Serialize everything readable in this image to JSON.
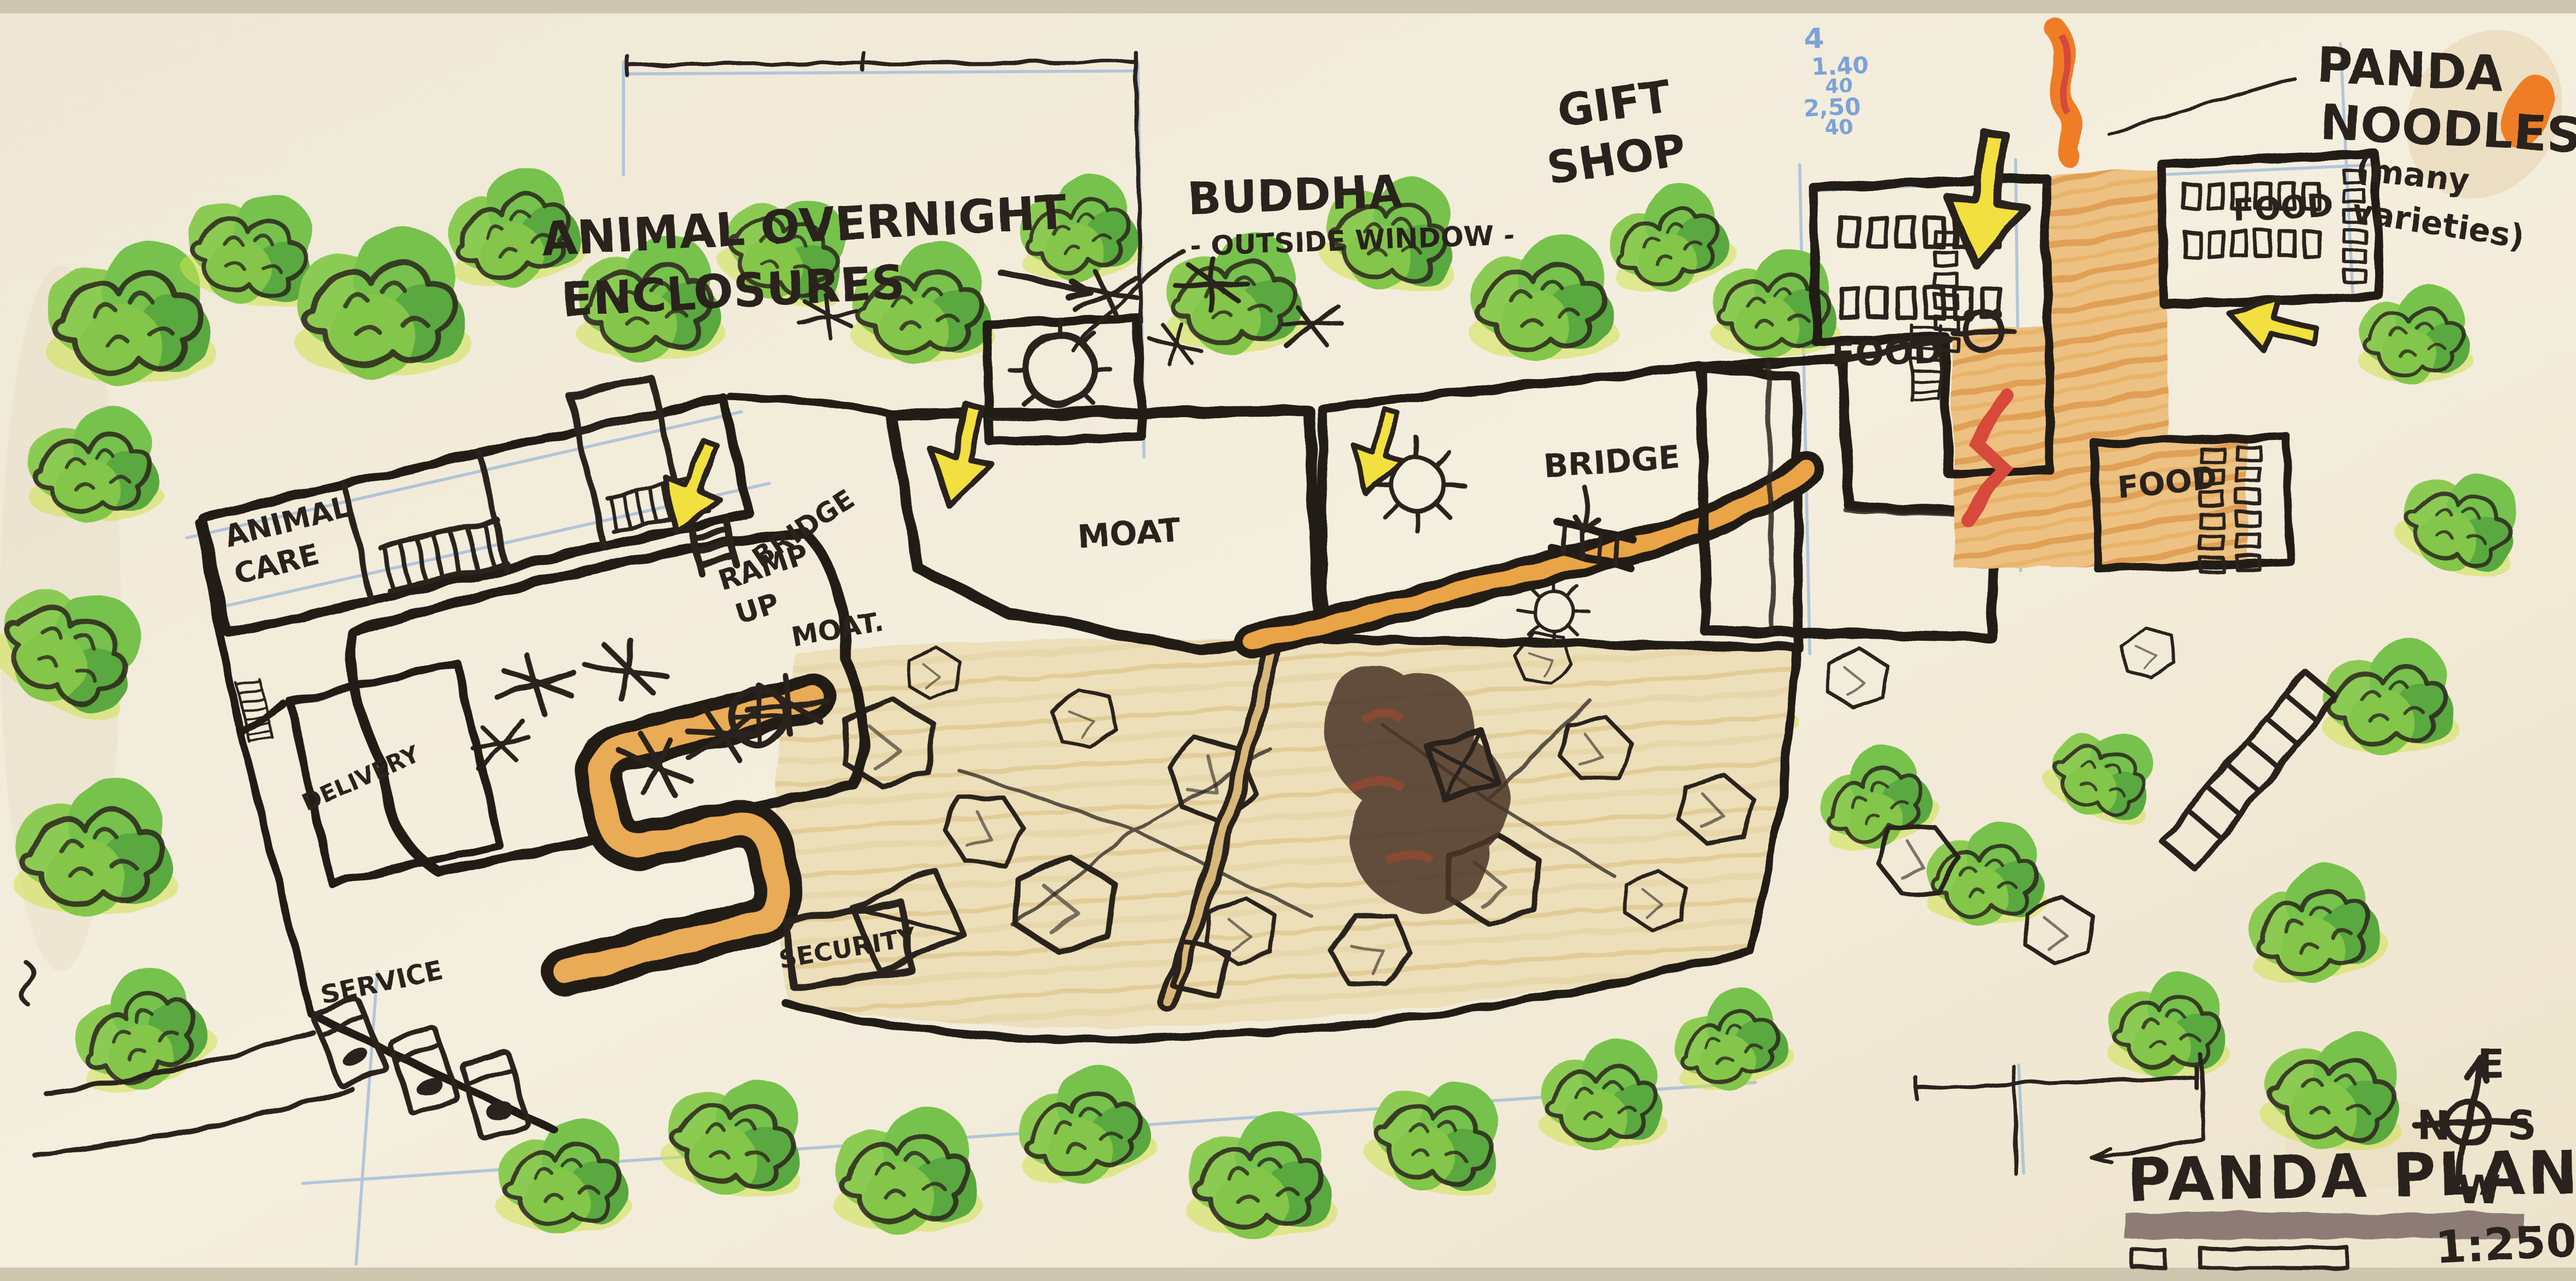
{
  "plan": {
    "title": "PANDA PLAN",
    "scale_ratio": "1:250",
    "labels": {
      "animal_overnight_1": "ANIMAL OVERNIGHT",
      "animal_overnight_2": "ENCLOSURES",
      "buddha": "BUDDHA",
      "buddha_sub": "- OUTSIDE WINDOW -",
      "gift_1": "GIFT",
      "gift_2": "SHOP",
      "noodles_1": "PANDA",
      "noodles_2": "NOODLES",
      "noodles_3": "(many",
      "noodles_4": "varieties)",
      "food_a": "FOOD",
      "food_b": "FOOD",
      "food_c": "FOOD",
      "animal_care_1": "ANIMAL",
      "animal_care_2": "CARE",
      "bridge_left": "BRIDGE",
      "ramp_1": "RAMP",
      "ramp_2": "UP",
      "moat_left": "MOAT.",
      "moat_main": "MOAT",
      "bridge_main": "BRIDGE",
      "delivery": "DELIVERY",
      "security": "SECURITY",
      "service": "SERVICE"
    },
    "compass": {
      "top": "E",
      "left": "N",
      "right": "S",
      "bottom": "W"
    },
    "blue_notes": [
      "4",
      "1.40",
      "40",
      "2,50",
      "40"
    ],
    "colors": {
      "legend_red": "#d95348",
      "legend_blue": "#7fb5d5",
      "scale_bar": "#8d7c74",
      "moat_pink": "#d2a0c2",
      "water_blue": "#c7e4ec",
      "path_orange": "#e9ab55",
      "vegetation_green": "#76c24e"
    }
  }
}
